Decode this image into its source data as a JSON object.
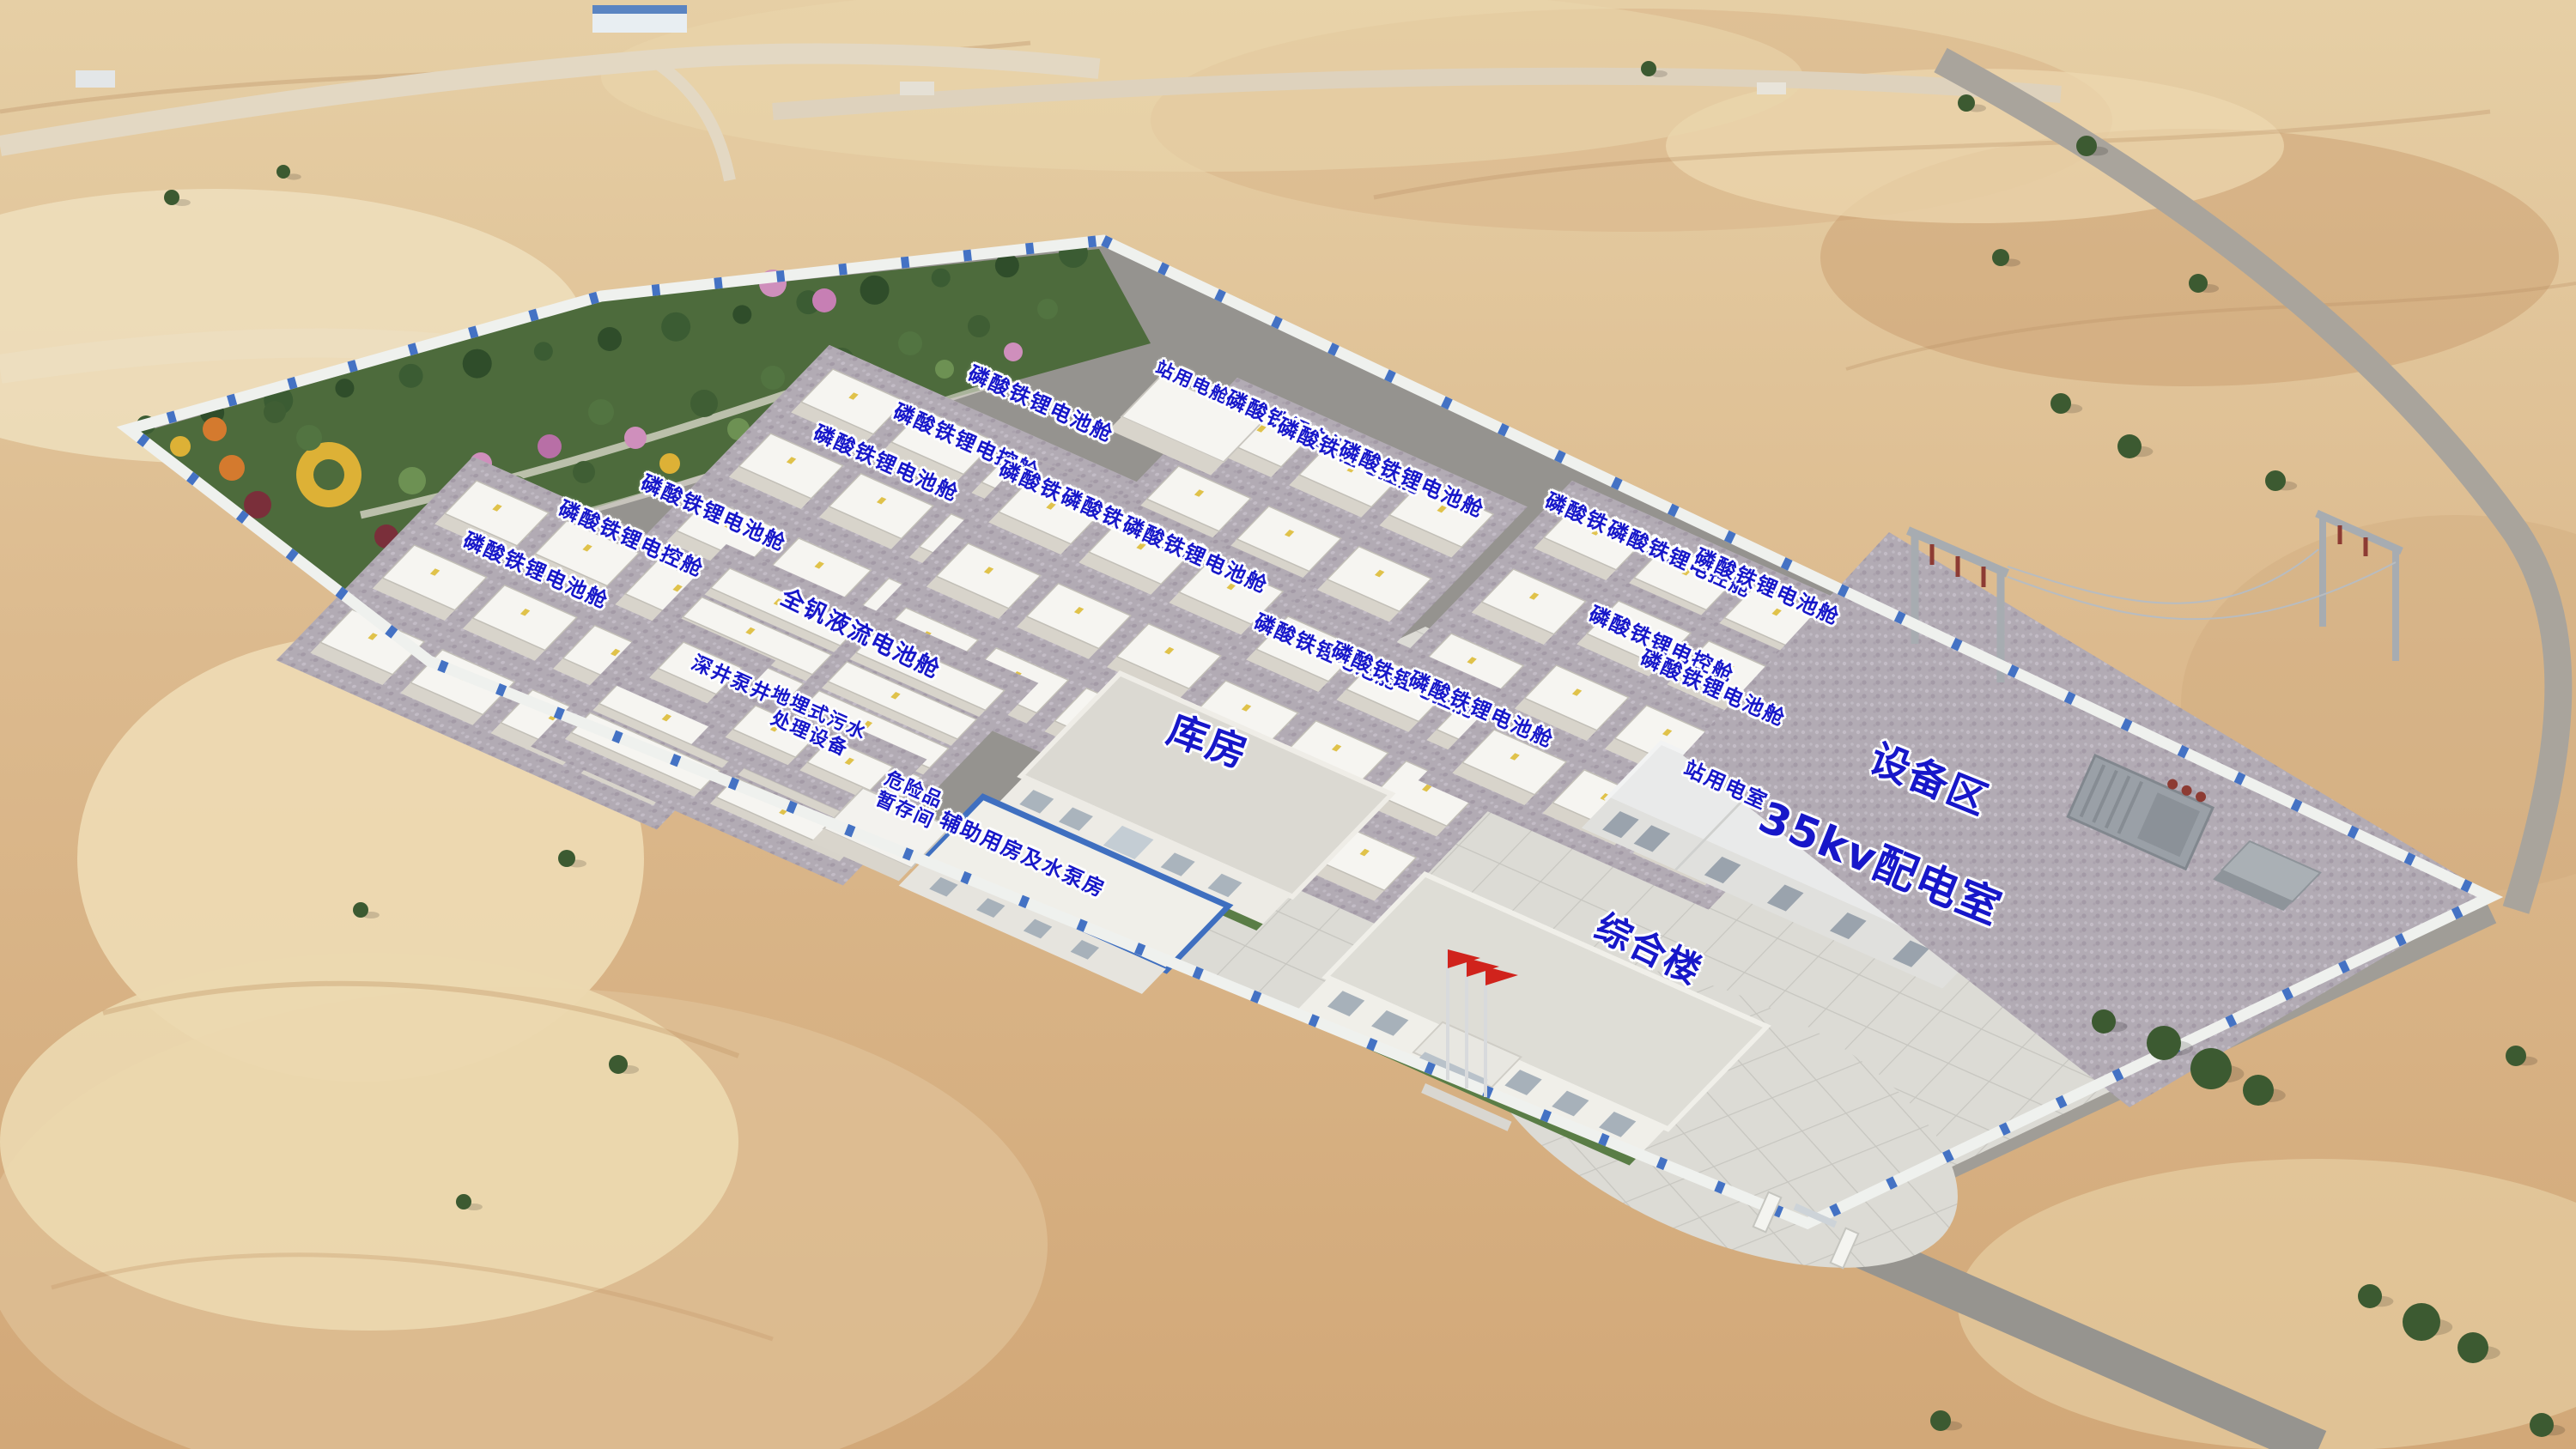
{
  "scene": {
    "description": "Aerial rendering of a desert battery energy storage power station with labeled buildings and battery container pads",
    "colors": {
      "label_blue": "#1717c9",
      "label_outline": "#ffffff",
      "fence_blue": "#4472c4",
      "fence_white": "#eff1ee",
      "sand": "#dcba8e",
      "road_gray": "#95938f",
      "pad_gravel": "#b2abb4",
      "plaza_tile": "#dcdbd5",
      "garden_green": "#4d6b3c",
      "container_white": "#f6f5f1",
      "flag_red": "#d0231c"
    }
  },
  "labels": [
    {
      "name": "label-station-power-room-north",
      "text": "站用电舱",
      "x": 46.3,
      "y": 26.4,
      "rot": 24,
      "size": 21
    },
    {
      "name": "label-lfp-battery-pod",
      "text": "磷酸铁锂电池舱",
      "x": 40.4,
      "y": 27.9,
      "rot": 24,
      "size": 24
    },
    {
      "name": "label-lfp-control-pod",
      "text": "磷酸铁锂电控舱",
      "x": 37.5,
      "y": 30.5,
      "rot": 24,
      "size": 24
    },
    {
      "name": "label-lfp-battery-pod",
      "text": "磷酸铁锂电池舱",
      "x": 34.4,
      "y": 32.0,
      "rot": 24,
      "size": 24
    },
    {
      "name": "label-lfp-battery-pod",
      "text": "磷酸铁锂电池舱",
      "x": 27.7,
      "y": 35.4,
      "rot": 24,
      "size": 24
    },
    {
      "name": "label-lfp-control-pod",
      "text": "磷酸铁锂电控舱",
      "x": 24.5,
      "y": 37.2,
      "rot": 24,
      "size": 24
    },
    {
      "name": "label-lfp-battery-pod",
      "text": "磷酸铁锂电池舱",
      "x": 20.8,
      "y": 39.4,
      "rot": 24,
      "size": 24
    },
    {
      "name": "label-lfp-battery-pod",
      "text": "磷酸铁锂电池舱",
      "x": 50.4,
      "y": 29.6,
      "rot": 24,
      "size": 24
    },
    {
      "name": "label-lfp-control-pod",
      "text": "磷酸铁锂电控舱",
      "x": 52.4,
      "y": 31.5,
      "rot": 24,
      "size": 24
    },
    {
      "name": "label-lfp-battery-pod",
      "text": "磷酸铁锂电池舱",
      "x": 54.8,
      "y": 33.1,
      "rot": 24,
      "size": 24
    },
    {
      "name": "label-lfp-battery-pod",
      "text": "磷酸铁锂电池舱",
      "x": 41.6,
      "y": 34.5,
      "rot": 24,
      "size": 24
    },
    {
      "name": "label-lfp-control-pod",
      "text": "磷酸铁锂电控舱",
      "x": 44.0,
      "y": 36.4,
      "rot": 24,
      "size": 24
    },
    {
      "name": "label-lfp-battery-pod",
      "text": "磷酸铁锂电池舱",
      "x": 46.4,
      "y": 38.3,
      "rot": 24,
      "size": 24
    },
    {
      "name": "label-lfp-battery-pod",
      "text": "磷酸铁锂电池舱",
      "x": 62.8,
      "y": 36.7,
      "rot": 24,
      "size": 24
    },
    {
      "name": "label-lfp-control-pod",
      "text": "磷酸铁锂电控舱",
      "x": 65.2,
      "y": 38.6,
      "rot": 24,
      "size": 24
    },
    {
      "name": "label-lfp-battery-pod",
      "text": "磷酸铁锂电池舱",
      "x": 68.6,
      "y": 40.5,
      "rot": 24,
      "size": 24
    },
    {
      "name": "label-lfp-battery-pod",
      "text": "磷酸铁锂电池舱",
      "x": 51.5,
      "y": 45.0,
      "rot": 24,
      "size": 24
    },
    {
      "name": "label-lfp-control-pod",
      "text": "磷酸铁锂电控舱",
      "x": 54.5,
      "y": 47.0,
      "rot": 24,
      "size": 24
    },
    {
      "name": "label-lfp-battery-pod",
      "text": "磷酸铁锂电池舱",
      "x": 57.5,
      "y": 49.0,
      "rot": 24,
      "size": 24
    },
    {
      "name": "label-lfp-control-pod",
      "text": "磷酸铁锂电控舱",
      "x": 64.5,
      "y": 44.5,
      "rot": 24,
      "size": 24
    },
    {
      "name": "label-lfp-battery-pod",
      "text": "磷酸铁锂电池舱",
      "x": 66.5,
      "y": 47.5,
      "rot": 24,
      "size": 24
    },
    {
      "name": "label-vanadium-flow-battery-pod",
      "text": "全钒液流电池舱",
      "x": 33.4,
      "y": 43.8,
      "rot": 26,
      "size": 27
    },
    {
      "name": "label-deep-well-pump",
      "text": "深井泵井",
      "x": 28.4,
      "y": 46.9,
      "rot": 24,
      "size": 23
    },
    {
      "name": "label-buried-sewage-treatment",
      "text": "地埋式污水\n处理设备",
      "x": 31.6,
      "y": 50.0,
      "rot": 24,
      "size": 22
    },
    {
      "name": "label-hazmat-temporary-storage",
      "text": "危险品\n暂存间",
      "x": 35.3,
      "y": 55.3,
      "rot": 24,
      "size": 22
    },
    {
      "name": "label-auxiliary-pump-house",
      "text": "辅助用房及水泵房",
      "x": 39.7,
      "y": 59.0,
      "rot": 24,
      "size": 24
    },
    {
      "name": "label-warehouse",
      "text": "库房",
      "x": 46.9,
      "y": 51.2,
      "rot": 20,
      "size": 46
    },
    {
      "name": "label-comprehensive-building",
      "text": "综合楼",
      "x": 64.0,
      "y": 65.5,
      "rot": 26,
      "size": 42
    },
    {
      "name": "label-station-power-room",
      "text": "站用电室",
      "x": 67.0,
      "y": 54.2,
      "rot": 24,
      "size": 24
    },
    {
      "name": "label-35kv-distribution-room",
      "text": "35kv配电室",
      "x": 73.0,
      "y": 59.6,
      "rot": 22,
      "size": 50
    },
    {
      "name": "label-equipment-area",
      "text": "设备区",
      "x": 74.9,
      "y": 53.8,
      "rot": 22,
      "size": 46
    }
  ]
}
